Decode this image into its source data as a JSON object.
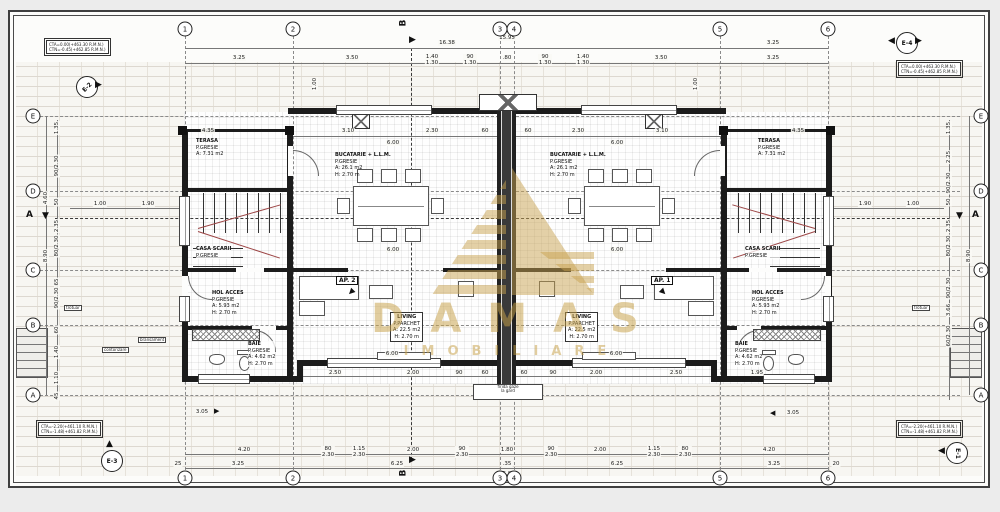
{
  "watermark": {
    "name": "DAMAS",
    "tagline": "IMOBILIARE",
    "color": "#c8a24f"
  },
  "grid": {
    "cols": [
      "1",
      "2",
      "3",
      "4",
      "5",
      "6"
    ],
    "rows": [
      "E",
      "D",
      "C",
      "B",
      "A"
    ],
    "section_vertical": "B",
    "section_horizontal": "A"
  },
  "markers": {
    "top_left": "E-2",
    "top_right": "E-4",
    "bottom_left": "E-3",
    "bottom_right": "E-1"
  },
  "notes": {
    "top_left": {
      "l1": "CTA=0.00(+463.30 R.M.N.)",
      "l2": "CTN=-0.45(+462.85 R.M.N.)"
    },
    "top_right": {
      "l1": "CTA=0.00(+463.30 R.M.N.)",
      "l2": "CTN=-0.45(+462.85 R.M.N.)"
    },
    "bottom_left": {
      "l1": "CTA=-2.20(+461.10 R.M.N.)",
      "l2": "CTN=-1.48(+461.82 R.M.N.)"
    },
    "bottom_right": {
      "l1": "CTA=-2.20(+461.10 R.M.N.)",
      "l2": "CTN=-1.48(+461.82 R.M.N.)"
    }
  },
  "apartments": {
    "left_tag": "AP. 2",
    "right_tag": "AP. 1"
  },
  "rooms": {
    "terasa": {
      "name": "TERASA",
      "finish": "P.GRESIE",
      "area": "A: 7.31 m2"
    },
    "bucatarie": {
      "name": "BUCATARIE + L.L.M.",
      "finish": "P.GRESIE",
      "area": "A: 26.1 m2",
      "height": "H: 2.70 m"
    },
    "casa_scarii": {
      "name": "CASA SCARII",
      "finish": "P.GRESIE"
    },
    "hol": {
      "name": "HOL ACCES",
      "finish": "P.GRESIE",
      "area": "A: 5.93 m2",
      "height": "H: 2.70 m"
    },
    "baie": {
      "name": "BAIE",
      "finish": "P.GRESIE",
      "area": "A: 4.62 m2",
      "height": "H: 2.70 m"
    },
    "living": {
      "name": "LIVING",
      "finish": "P.PARCHET",
      "area": "A: 22.5 m2",
      "height": "H: 2.70 m"
    }
  },
  "annotations": {
    "firida_l1": "firida gaze",
    "firida_l2": "la gard",
    "trotuar": "trotuar",
    "contorizare": "contorizare",
    "bransament": "bransament",
    "slope_left": "3.05",
    "slope_right": "3.05"
  },
  "dims": {
    "overall_top": "16.38",
    "secondary_top": "15.95",
    "right_top": "3.25",
    "bottom_total": "15.95",
    "top": [
      "3.25",
      "3.50",
      "1.40\n1.30",
      "90\n1.30",
      ".80",
      "90\n1.30",
      "1.40\n1.30",
      "3.50",
      "3.25"
    ],
    "bottom1": [
      "4.20",
      "80\n2.30",
      "1.15\n2.30",
      "2.00",
      "90\n2.30",
      "1.80",
      "90\n2.30",
      "2.00",
      "1.15\n2.30",
      "80\n2.30",
      "4.20"
    ],
    "bottom2": [
      "25",
      "3.25",
      "6.25",
      ".35",
      "6.25",
      "3.25",
      "20"
    ],
    "left": [
      "1.35",
      "90/2.30",
      "50",
      "2.35",
      "80/2.30",
      "65",
      "90/2.30",
      "60",
      "1.40",
      "1.10",
      "45"
    ],
    "left_totals": [
      "4.60",
      "8.90"
    ],
    "right": [
      "1.35",
      "2.25",
      "90/2.30",
      "50",
      "2.35",
      "80/2.30",
      "90/2.30",
      "3.66",
      "60/2.30"
    ],
    "right_totals": [
      "8.90"
    ],
    "inner_top": [
      "4.35",
      "3.10",
      "2.30",
      "60",
      "60",
      "2.30",
      "3.10",
      "4.35"
    ],
    "inner_width": "6.00",
    "inner_bottom": [
      "2.50",
      "2.00",
      "90",
      "60",
      "60",
      "90",
      "2.00",
      "2.50",
      "1.95"
    ],
    "terrace_left": [
      "1.00",
      "1.90"
    ],
    "terrace_right": [
      "1.90",
      "1.00"
    ],
    "window_vert": "1.00"
  }
}
